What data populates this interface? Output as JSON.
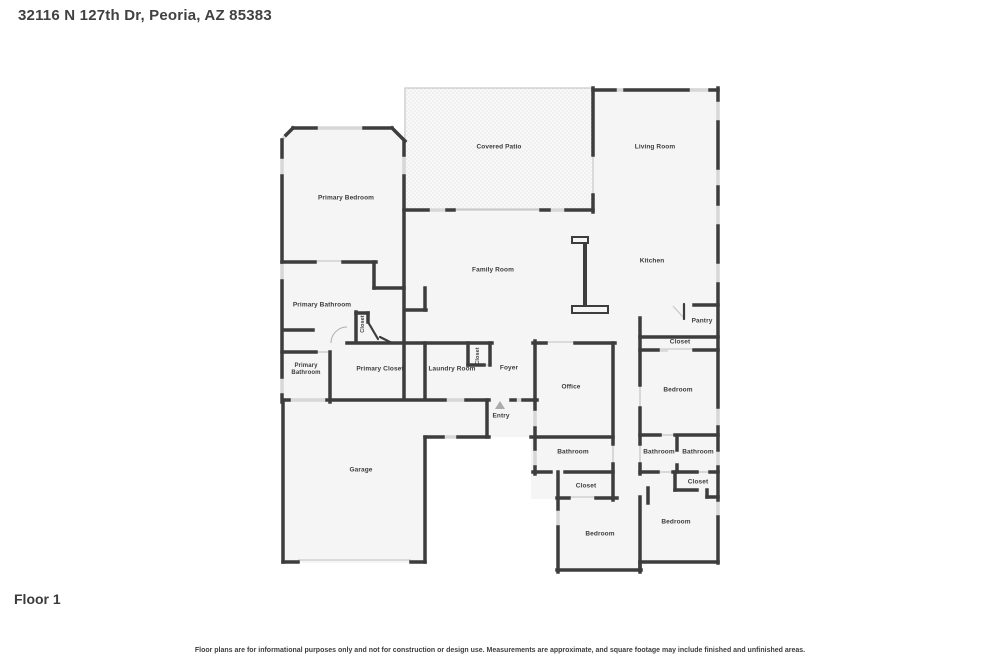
{
  "page": {
    "address_title": "32116 N 127th Dr, Peoria, AZ 85383",
    "floor_label": "Floor 1",
    "disclaimer": "Floor plans are for informational purposes only and not for construction or design use. Measurements are approximate, and square footage may include finished and unfinished areas."
  },
  "colors": {
    "wall": "#3d3d3d",
    "window": "#d7d7d7",
    "room_fill": "#f5f5f6",
    "patio_dots": "#cfcfcf",
    "text": "#3c3c3c",
    "entry_marker": "#ababab"
  },
  "icons": {
    "entry_marker": "triangle-up-icon"
  },
  "rooms": {
    "covered_patio": {
      "label": "Covered Patio"
    },
    "living_room": {
      "label": "Living Room"
    },
    "primary_bedroom": {
      "label": "Primary Bedroom"
    },
    "family_room": {
      "label": "Family Room"
    },
    "kitchen": {
      "label": "Kitchen"
    },
    "primary_bathroom": {
      "label": "Primary Bathroom"
    },
    "closet_hall": {
      "label": "Closet"
    },
    "pantry": {
      "label": "Pantry"
    },
    "closet_pantry": {
      "label": "Closet"
    },
    "primary_bathroom_2": {
      "label": "Primary Bathroom"
    },
    "primary_closet": {
      "label": "Primary Closet"
    },
    "laundry_room": {
      "label": "Laundry Room"
    },
    "closet_laundry": {
      "label": "Closet"
    },
    "foyer": {
      "label": "Foyer"
    },
    "office": {
      "label": "Office"
    },
    "bedroom_1": {
      "label": "Bedroom"
    },
    "entry": {
      "label": "Entry"
    },
    "garage": {
      "label": "Garage"
    },
    "bathroom_1": {
      "label": "Bathroom"
    },
    "bathroom_2": {
      "label": "Bathroom"
    },
    "bathroom_3": {
      "label": "Bathroom"
    },
    "closet_1": {
      "label": "Closet"
    },
    "closet_2": {
      "label": "Closet"
    },
    "bedroom_2": {
      "label": "Bedroom"
    },
    "bedroom_3": {
      "label": "Bedroom"
    }
  }
}
